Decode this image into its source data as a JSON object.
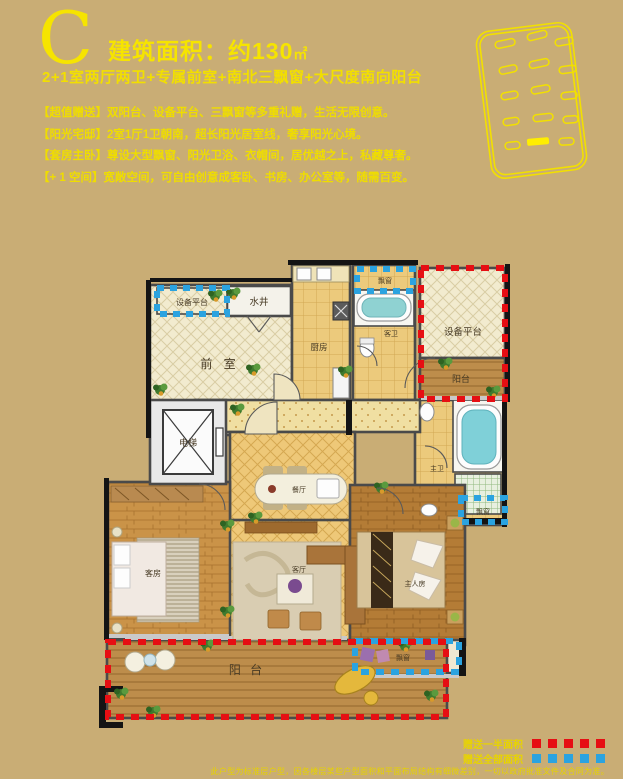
{
  "colors": {
    "background": "#c9ad75",
    "accent_yellow": "#f6e400",
    "gift_half_red": "#e60e13",
    "gift_full_blue": "#2ba3e0"
  },
  "header": {
    "plan_letter": "C",
    "area_label": "建筑面积：约130",
    "area_unit": "㎡",
    "subtitle": "2+1室两厅两卫+专属前室+南北三飘窗+大尺度南向阳台",
    "features": [
      {
        "tag": "【超值赠送】",
        "text": "双阳台、设备平台、三飘窗等多重礼赠，生活无限创意。"
      },
      {
        "tag": "【阳光宅邸】",
        "text": "2室1厅1卫朝南，超长阳光居室线，奢享阳光心境。"
      },
      {
        "tag": "【套房主卧】",
        "text": "尊设大型飘窗、阳光卫浴、衣帽间，居优越之上，私藏尊奢。"
      },
      {
        "tag": "【+ 1 空间】",
        "text": "宽敞空间，可自由创意成客卧、书房、办公室等，随需百变。"
      }
    ]
  },
  "plan": {
    "rooms": {
      "equip_left": "设备平台",
      "water_well": "水井",
      "front_room": "前 室",
      "elevator": "电梯",
      "kitchen": "厨房",
      "bay_top": "飘窗",
      "guest_bath": "客卫",
      "equip_right": "设备平台",
      "balcony_right": "阳台",
      "master_bath": "主卫",
      "bay_right": "飘窗",
      "dining": "餐厅",
      "guest_room": "客房",
      "living": "客厅",
      "master_room": "主人房",
      "bay_bottom": "飘窗",
      "balcony_south": "阳 台"
    }
  },
  "legend": {
    "half_label": "赠送一半面积",
    "full_label": "赠送全部面积"
  },
  "footer": {
    "disclaimer": "此户型为标准层户型，因各楼层某些户型面积和平面布局结构有细微差别，一切以政府批准文件及合同为准。"
  }
}
